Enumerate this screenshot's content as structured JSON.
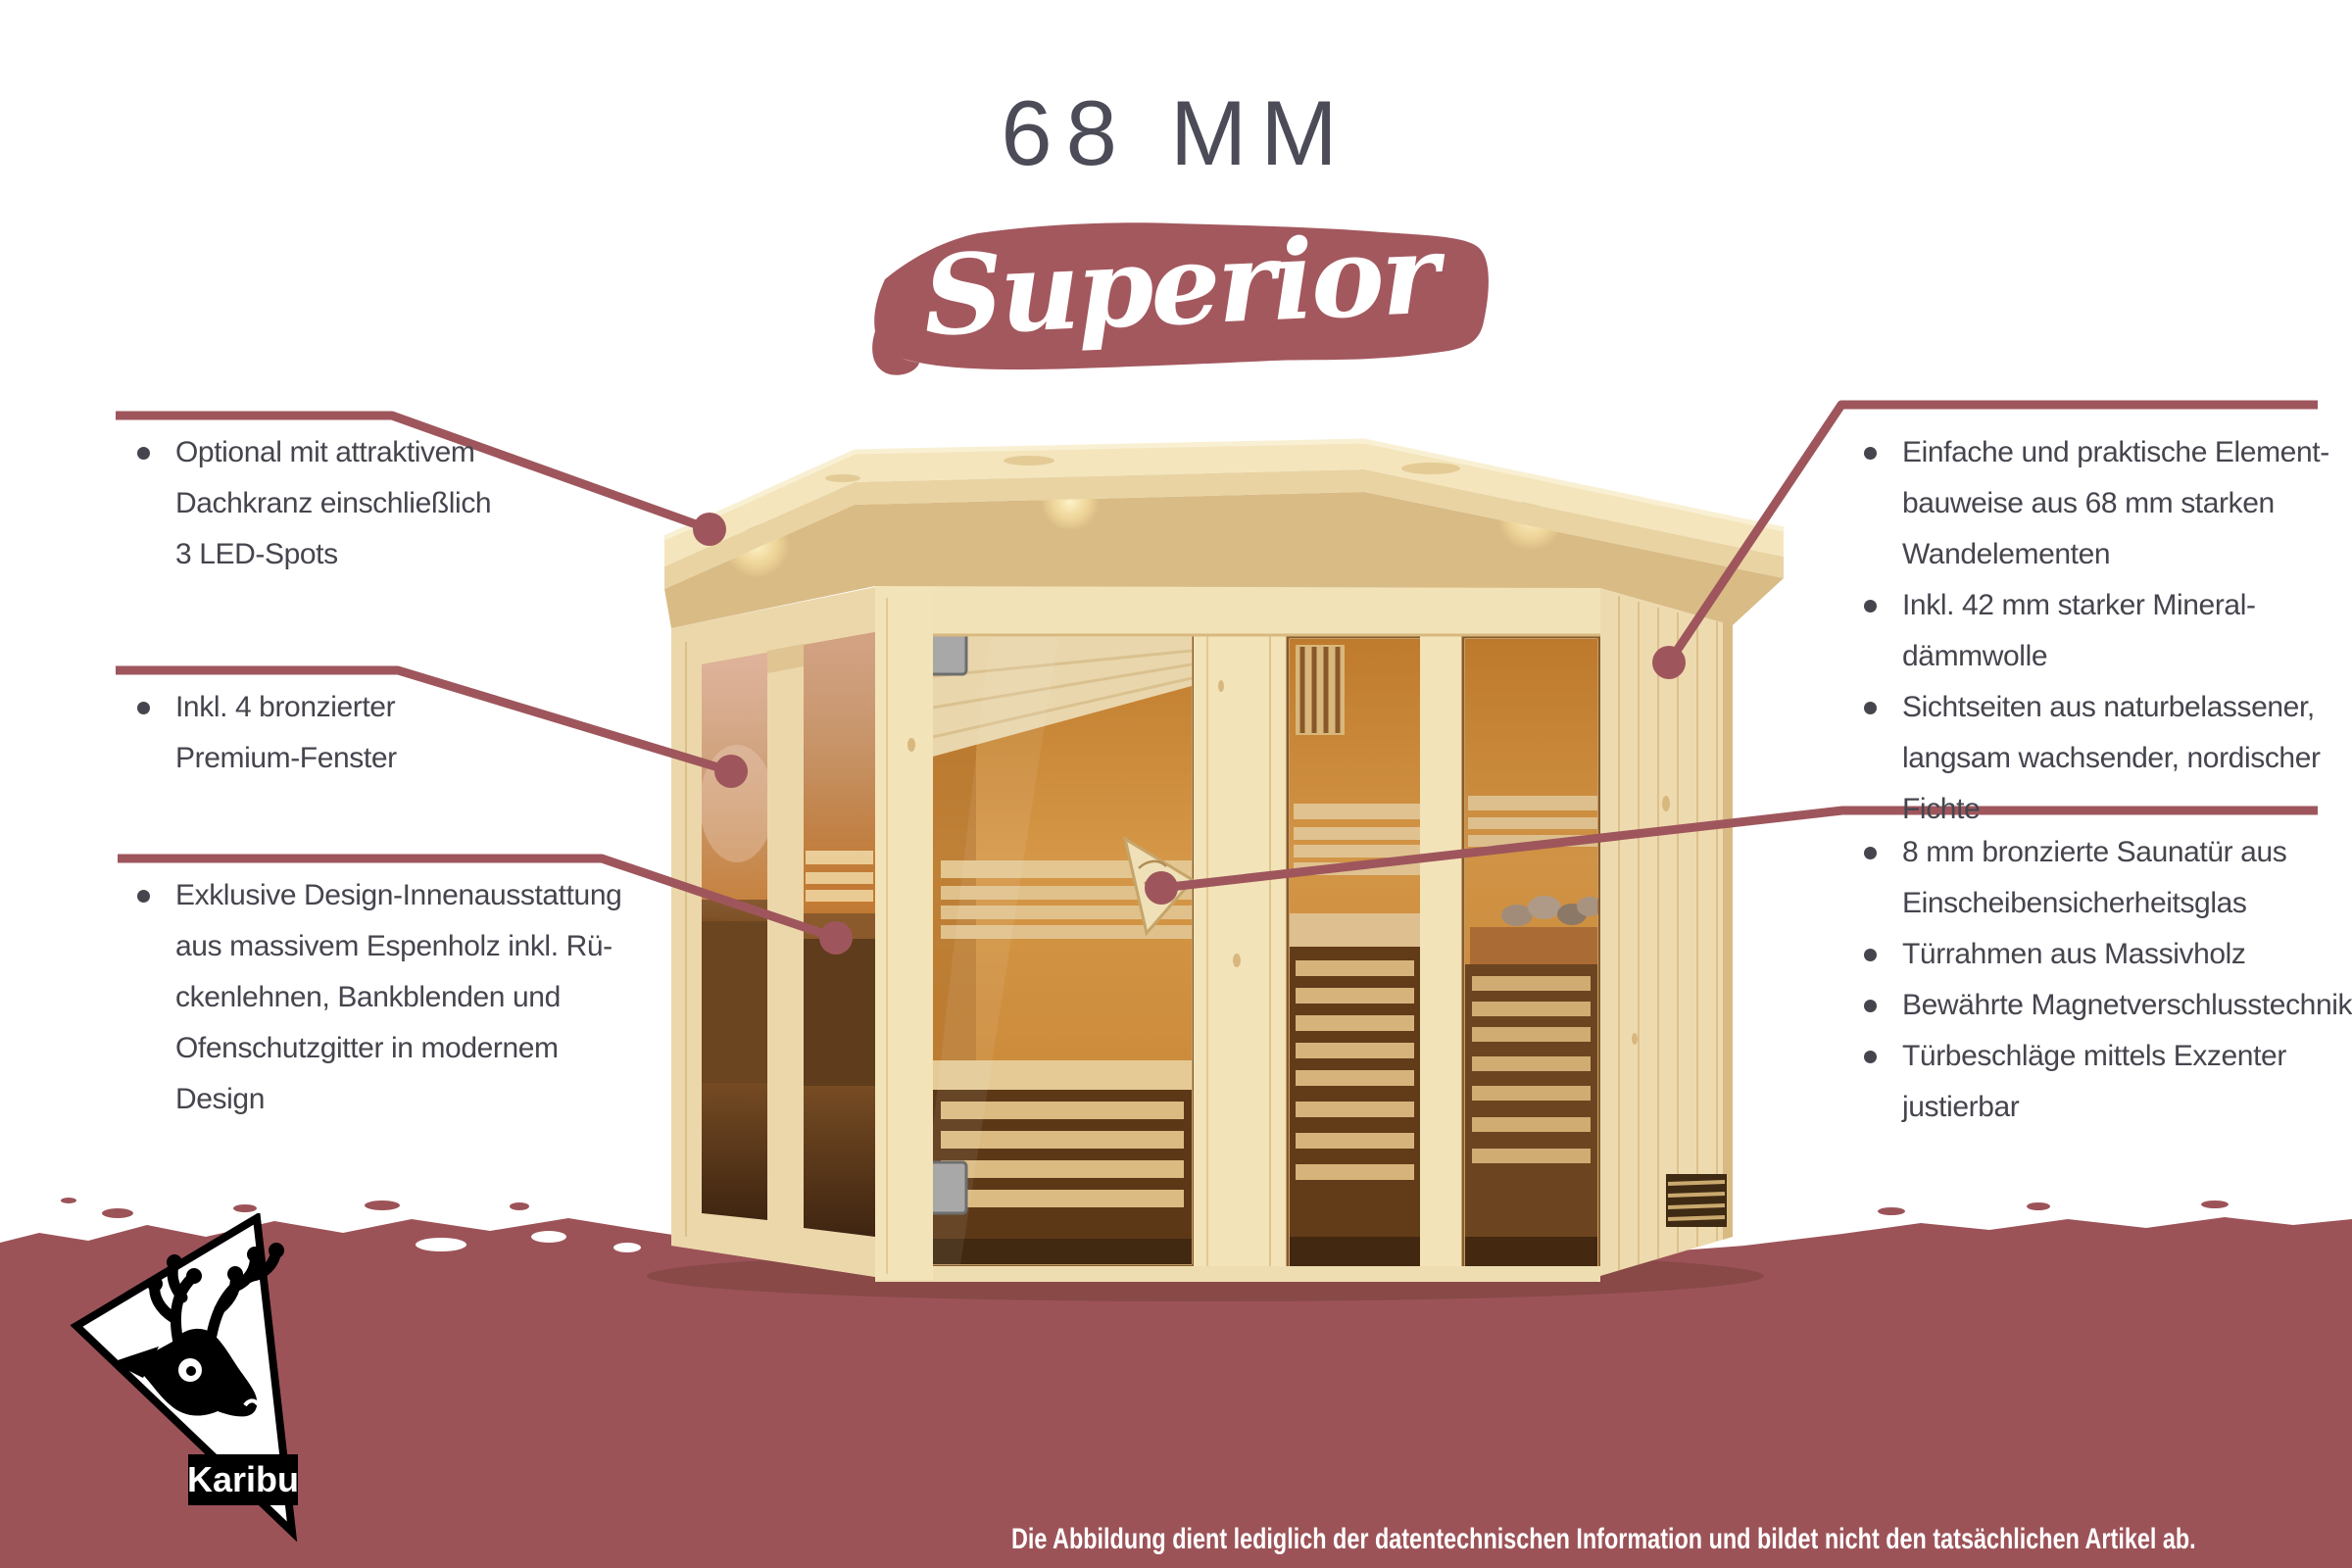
{
  "title": "68 MM",
  "badge": {
    "label": "Superior"
  },
  "callouts": {
    "left": [
      {
        "lines": [
          "Optional mit attraktivem",
          "Dachkranz einschließlich",
          "3 LED-Spots"
        ]
      },
      {
        "lines": [
          "Inkl. 4 bronzierter",
          "Premium-Fenster"
        ]
      },
      {
        "lines": [
          "Exklusive Design-Innenausstattung",
          "aus massivem Espenholz inkl. Rü-",
          "ckenlehnen, Bankblenden und",
          "Ofenschutzgitter in modernem",
          "Design"
        ]
      }
    ],
    "right_top": [
      {
        "lines": [
          "Einfache und praktische Element-",
          "bauweise aus 68 mm starken",
          "Wandelementen"
        ]
      },
      {
        "lines": [
          "Inkl. 42 mm starker Mineral-",
          "dämmwolle"
        ]
      },
      {
        "lines": [
          "Sichtseiten aus naturbelassener,",
          "langsam wachsender, nordischer",
          "Fichte"
        ]
      }
    ],
    "right_bottom": [
      {
        "lines": [
          "8 mm bronzierte Saunatür aus",
          "Einscheibensicherheitsglas"
        ]
      },
      {
        "lines": [
          "Türrahmen aus Massivholz"
        ]
      },
      {
        "lines": [
          "Bewährte Magnetverschlusstechnik"
        ]
      },
      {
        "lines": [
          "Türbeschläge mittels Exzenter",
          "justierbar"
        ]
      }
    ]
  },
  "footer": {
    "disclaimer": "Die Abbildung dient lediglich der datentechnischen Information und bildet nicht den tatsächlichen Artikel ab."
  },
  "logo": {
    "brand": "Karibu"
  },
  "colors": {
    "accent": "#9E565C",
    "banner": "#A3585E",
    "bottom_band": "#9C5358",
    "title_text": "#4C4C58",
    "body_text": "#45454E",
    "wood_light": "#F2E2B8",
    "glass_bronze": "#C9822F"
  }
}
